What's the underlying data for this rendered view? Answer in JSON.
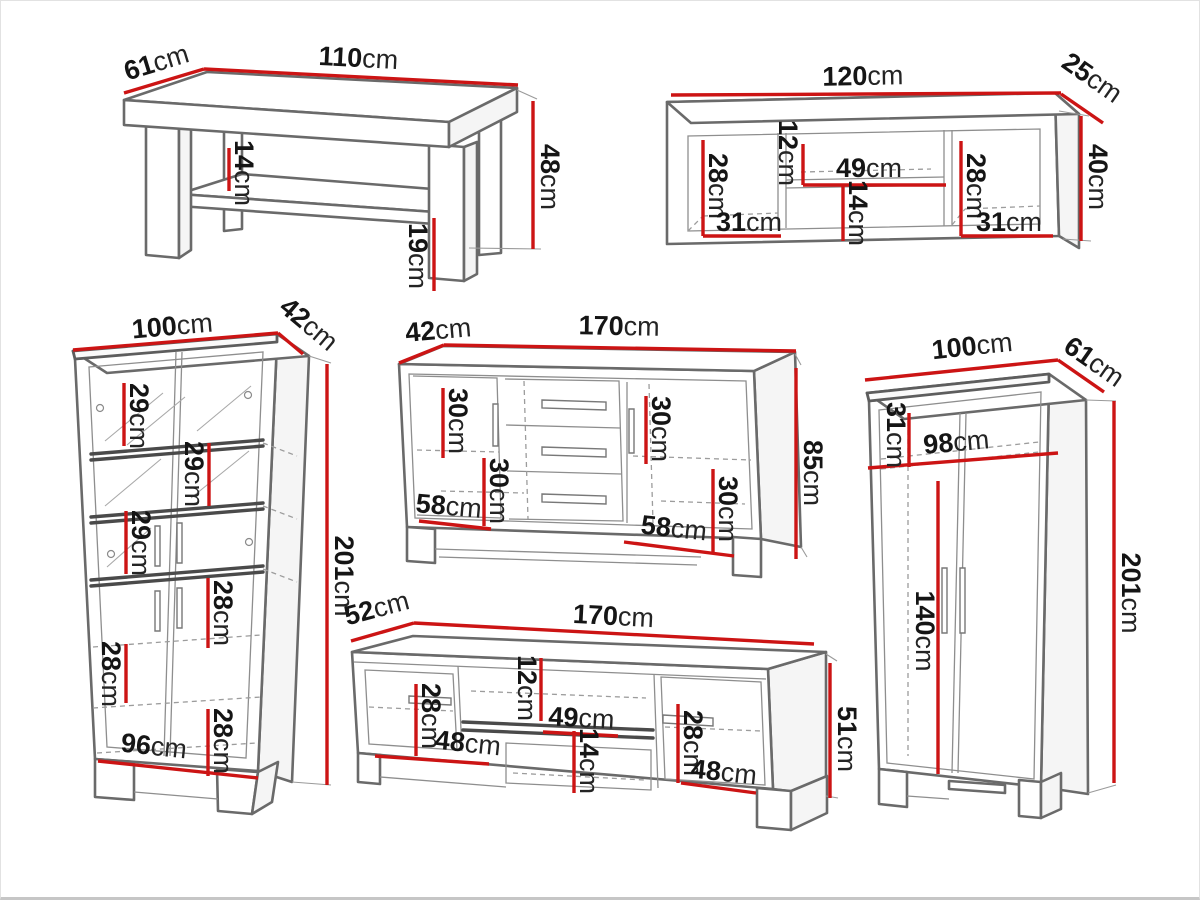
{
  "canvas": {
    "width": 1200,
    "height": 900,
    "background": "#ffffff"
  },
  "style": {
    "dimension_color": "#cc1414",
    "outline_color": "#6a6a6a",
    "text_color": "#151515"
  },
  "unit": "cm",
  "furniture": {
    "coffee_table": {
      "name": "coffee table",
      "width": {
        "v": "110",
        "u": "cm"
      },
      "depth": {
        "v": "61",
        "u": "cm"
      },
      "height": {
        "v": "48",
        "u": "cm"
      },
      "shelf_gap": {
        "v": "14",
        "u": "cm"
      },
      "clearance": {
        "v": "19",
        "u": "cm"
      }
    },
    "wall_shelf": {
      "name": "wall shelf",
      "width": {
        "v": "120",
        "u": "cm"
      },
      "depth": {
        "v": "25",
        "u": "cm"
      },
      "height": {
        "v": "40",
        "u": "cm"
      },
      "left_inner_height": {
        "v": "28",
        "u": "cm"
      },
      "left_inner_width": {
        "v": "31",
        "u": "cm"
      },
      "mid_top_height": {
        "v": "12",
        "u": "cm"
      },
      "mid_width": {
        "v": "49",
        "u": "cm"
      },
      "mid_bottom_height": {
        "v": "14",
        "u": "cm"
      },
      "right_inner_height": {
        "v": "28",
        "u": "cm"
      },
      "right_inner_width": {
        "v": "31",
        "u": "cm"
      }
    },
    "display_cabinet": {
      "name": "display cabinet",
      "width": {
        "v": "100",
        "u": "cm"
      },
      "depth": {
        "v": "42",
        "u": "cm"
      },
      "height": {
        "v": "201",
        "u": "cm"
      },
      "shelf_1": {
        "v": "29",
        "u": "cm"
      },
      "shelf_2": {
        "v": "29",
        "u": "cm"
      },
      "shelf_3": {
        "v": "29",
        "u": "cm"
      },
      "shelf_4": {
        "v": "28",
        "u": "cm"
      },
      "shelf_5": {
        "v": "28",
        "u": "cm"
      },
      "shelf_6": {
        "v": "28",
        "u": "cm"
      },
      "inner_width": {
        "v": "96",
        "u": "cm"
      }
    },
    "sideboard": {
      "name": "sideboard",
      "depth": {
        "v": "42",
        "u": "cm"
      },
      "width": {
        "v": "170",
        "u": "cm"
      },
      "height": {
        "v": "85",
        "u": "cm"
      },
      "left_top_height": {
        "v": "30",
        "u": "cm"
      },
      "left_bottom_height": {
        "v": "30",
        "u": "cm"
      },
      "left_width": {
        "v": "58",
        "u": "cm"
      },
      "right_top_height": {
        "v": "30",
        "u": "cm"
      },
      "right_bottom_height": {
        "v": "30",
        "u": "cm"
      },
      "right_width": {
        "v": "58",
        "u": "cm"
      }
    },
    "wardrobe": {
      "name": "wardrobe",
      "width": {
        "v": "100",
        "u": "cm"
      },
      "depth": {
        "v": "61",
        "u": "cm"
      },
      "height": {
        "v": "201",
        "u": "cm"
      },
      "top_shelf_height": {
        "v": "31",
        "u": "cm"
      },
      "inner_width": {
        "v": "98",
        "u": "cm"
      },
      "hanging_height": {
        "v": "140",
        "u": "cm"
      }
    },
    "tv_stand": {
      "name": "tv stand",
      "depth": {
        "v": "52",
        "u": "cm"
      },
      "width": {
        "v": "170",
        "u": "cm"
      },
      "height": {
        "v": "51",
        "u": "cm"
      },
      "left_height": {
        "v": "28",
        "u": "cm"
      },
      "left_width": {
        "v": "48",
        "u": "cm"
      },
      "mid_top_height": {
        "v": "12",
        "u": "cm"
      },
      "mid_width": {
        "v": "49",
        "u": "cm"
      },
      "mid_bottom_height": {
        "v": "14",
        "u": "cm"
      },
      "right_height": {
        "v": "28",
        "u": "cm"
      },
      "right_width": {
        "v": "48",
        "u": "cm"
      }
    }
  }
}
